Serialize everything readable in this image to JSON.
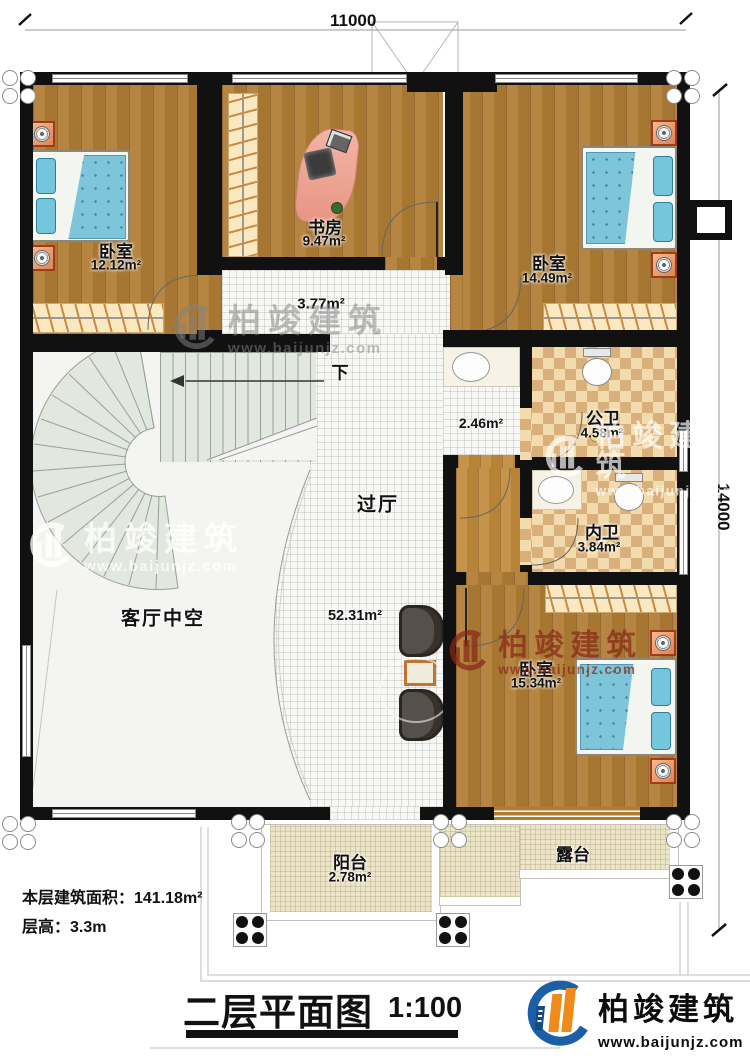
{
  "plan": {
    "dim_top": "11000",
    "dim_right": "14000",
    "rooms": {
      "bedroom_tl": {
        "name": "卧室",
        "area": "12.12m²"
      },
      "study": {
        "name": "书房",
        "area": "9.47m²"
      },
      "bedroom_tr": {
        "name": "卧室",
        "area": "14.49m²"
      },
      "hallway": {
        "area": "3.77m²"
      },
      "stairs": {
        "down": "下"
      },
      "corridor": {
        "area": "2.46m²"
      },
      "public_bath": {
        "name": "公卫",
        "area": "4.58m²"
      },
      "private_bath": {
        "name": "内卫",
        "area": "3.84m²"
      },
      "hall": {
        "name": "过厅",
        "area": "52.31m²"
      },
      "living_void": {
        "name": "客厅中空"
      },
      "bedroom_br": {
        "name": "卧室",
        "area": "15.34m²"
      },
      "balcony": {
        "name": "阳台",
        "area": "2.78m²"
      },
      "terrace": {
        "name": "露台"
      }
    }
  },
  "footer": {
    "area_note": "本层建筑面积：141.18m²",
    "height_note": "层高：3.3m",
    "title": "二层平面图",
    "scale": "1:100"
  },
  "brand": {
    "name": "柏竣建筑",
    "website": "www.baijunjz.com"
  },
  "watermark": {
    "name": "柏竣建筑",
    "website": "www.baijunjz.com"
  },
  "colors": {
    "wall": "#111111",
    "wood": "#b07c34",
    "bath_tile": "#f2dcae",
    "bath_checker": "#d9b07b",
    "hall_tile": "#f7f7f5",
    "stair": "#e2e8df",
    "balcony": "#ece4c6",
    "bed_blue": "#7fc5da",
    "nightstand_orange": "#e89a6b",
    "logo_blue": "#1a5fa8",
    "logo_orange": "#f08a1d",
    "watermark_red": "#8b2a1c"
  }
}
